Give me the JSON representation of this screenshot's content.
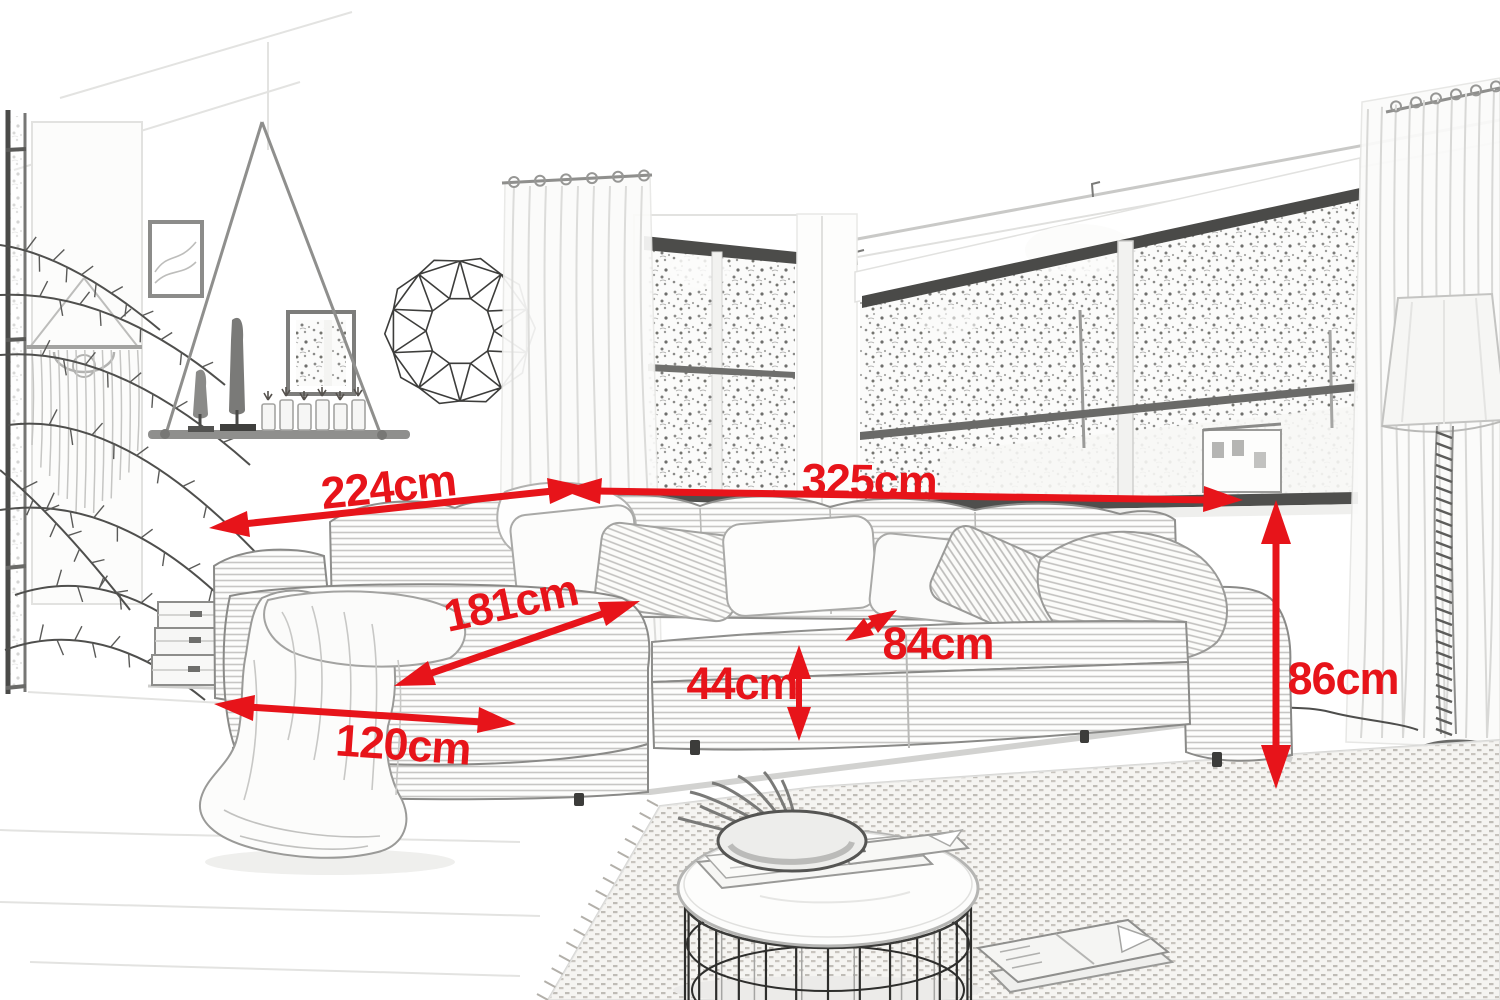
{
  "annotation": {
    "color": "#e7141a",
    "unit": "cm"
  },
  "dimensions": [
    {
      "name": "total-width-left-arm",
      "label": "224cm"
    },
    {
      "name": "total-width-right-arm",
      "label": "325cm"
    },
    {
      "name": "chaise-diagonal-depth",
      "label": "181cm"
    },
    {
      "name": "seat-depth",
      "label": "84cm"
    },
    {
      "name": "seat-height",
      "label": "44cm"
    },
    {
      "name": "chaise-front-width",
      "label": "120cm"
    },
    {
      "name": "overall-height",
      "label": "86cm"
    }
  ],
  "scene_objects": [
    "corner-sofa",
    "back-cushions",
    "throw-pillows",
    "throw-blanket",
    "rope-hanging-shelf",
    "wooden-statuettes",
    "candle-votives",
    "mountain-picture-frame",
    "botanical-picture-frame",
    "geometric-wall-wreath",
    "macrame-wall-hanging",
    "palm-plant",
    "glass-door",
    "corner-windows",
    "sheer-curtains",
    "stacked-storage-crates",
    "woven-rug",
    "round-wire-coffee-table",
    "decor-bowl",
    "magazines",
    "rope-floor-lamp"
  ]
}
